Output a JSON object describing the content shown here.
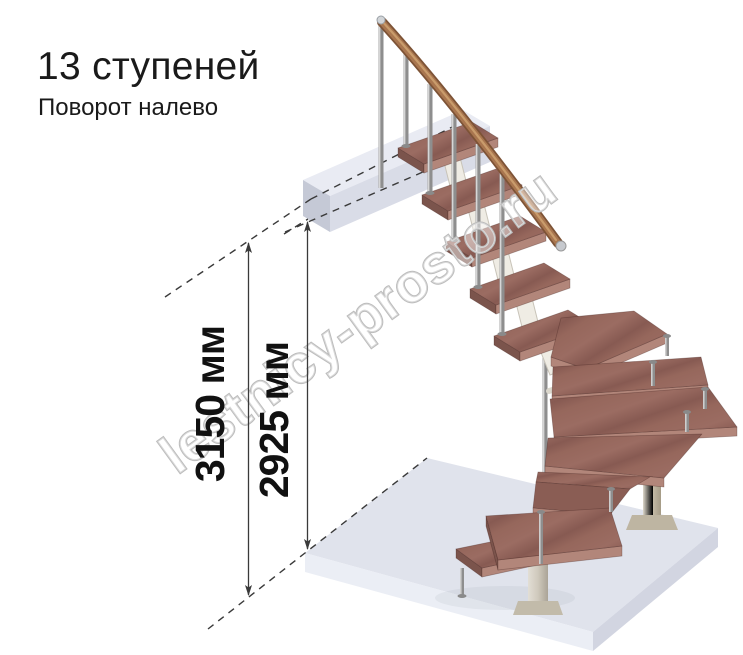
{
  "page": {
    "width": 743,
    "height": 655,
    "background": "#ffffff"
  },
  "header": {
    "title": "13 ступеней",
    "subtitle": "Поворот налево"
  },
  "diagram": {
    "steps_count": 13,
    "turn_direction": "налево",
    "dimensions": [
      {
        "id": "overall-height",
        "label": "3150 мм",
        "value": 3150,
        "unit": "мм"
      },
      {
        "id": "floor-to-ceiling-height",
        "label": "2925 мм",
        "value": 2925,
        "unit": "мм"
      }
    ],
    "watermark": "lestnicy-prosto.ru",
    "colors": {
      "tread_wood": "#916358",
      "tread_edge_light": "#b2867a",
      "tread_side_dark": "#7b544c",
      "handrail_wood": "#a9764f",
      "metal_baluster": "#9a9a9a",
      "support_modules": "#efece4",
      "column_tan": "#c8bfae",
      "column_gray": "#d5d1c8",
      "floor_slab": "#e0e3ec",
      "landing_slab": "#e9ebf3",
      "dimension_lines": "#3a3a3a",
      "watermark_outline": "#bcbcbc",
      "text": "#1a1a1a"
    }
  }
}
